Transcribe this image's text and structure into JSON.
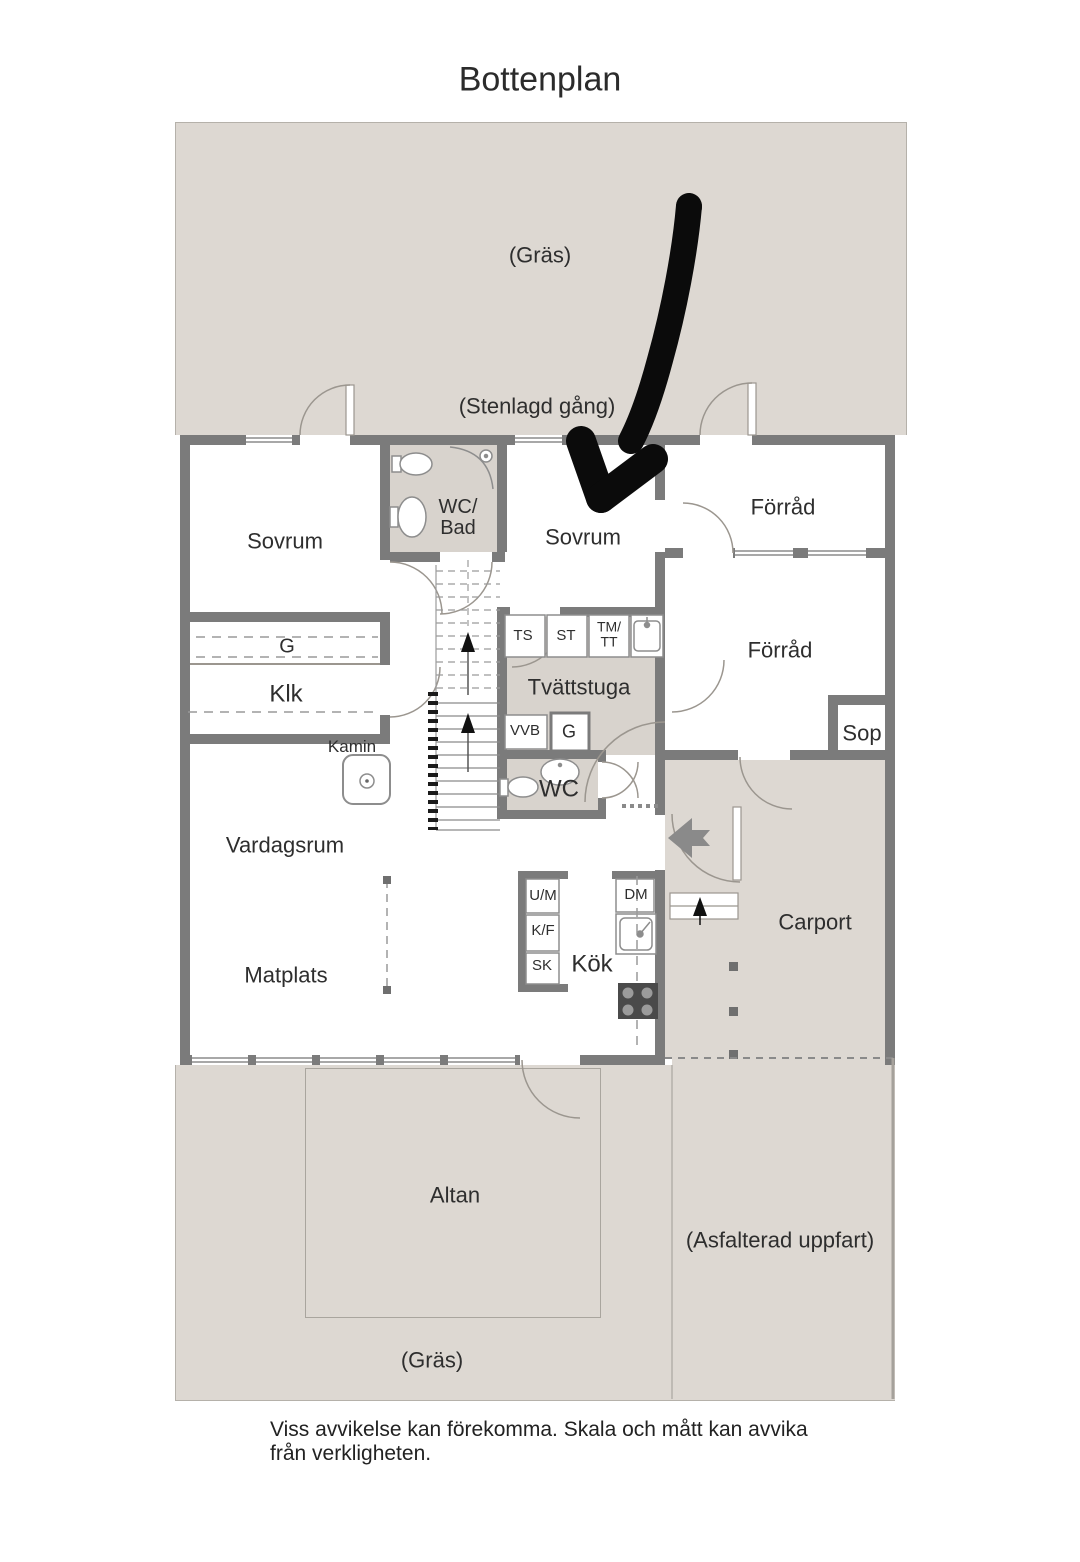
{
  "page": {
    "title": "Bottenplan",
    "disclaimer": "Viss avvikelse kan förekomma. Skala och mått kan avvika från verkligheten."
  },
  "colors": {
    "wall": "#7b7b7b",
    "outdoor_fill": "#ddd8d2",
    "wet_room_floor": "#d8d3cd",
    "door_arc_line": "#9b968f",
    "annotation": "#0b0b0b"
  },
  "outdoor": {
    "grass_top": "(Gräs)",
    "stone_path": "(Stenlagd gång)",
    "grass_bottom": "(Gräs)",
    "driveway": "(Asfalterad uppfart)",
    "patio": "Altan",
    "carport": "Carport"
  },
  "rooms": {
    "bedroom_left": "Sovrum",
    "bedroom_right": "Sovrum",
    "bathroom_line1": "WC/",
    "bathroom_line2": "Bad",
    "storage_upper": "Förråd",
    "storage_lower": "Förråd",
    "refuse": "Sop",
    "closet": "Klk",
    "wardrobe": "G",
    "fireplace": "Kamin",
    "laundry": "Tvättstuga",
    "toilet": "WC",
    "living": "Vardagsrum",
    "dining": "Matplats",
    "kitchen": "Kök"
  },
  "appliances": {
    "ts": "TS",
    "st": "ST",
    "tmtt_line1": "TM/",
    "tmtt_line2": "TT",
    "vvb": "VVB",
    "g": "G",
    "um": "U/M",
    "kf": "K/F",
    "sk": "SK",
    "dm": "DM"
  },
  "annotation": {
    "icon": "hand-drawn-arrow",
    "points_at": "bedroom_right"
  }
}
